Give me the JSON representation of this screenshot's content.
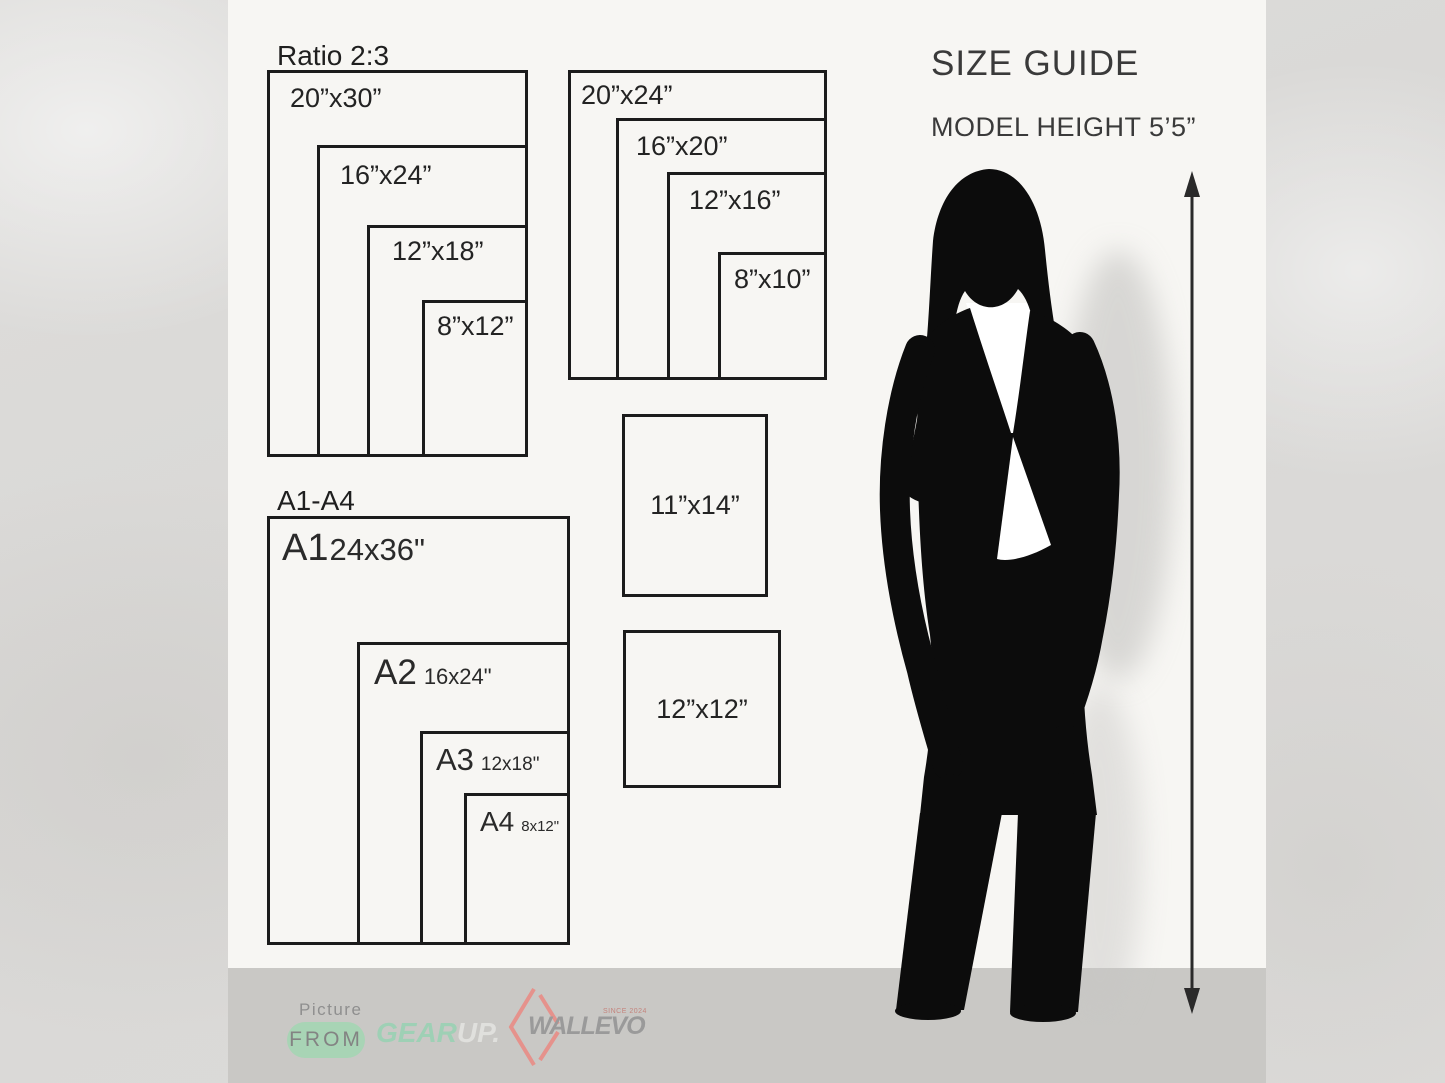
{
  "header": {
    "title": "SIZE GUIDE",
    "subtitle": "MODEL HEIGHT 5’5”"
  },
  "ratio_group": {
    "title": "Ratio 2:3",
    "sizes": [
      "20”x30”",
      "16”x24”",
      "12”x18”",
      "8”x12”"
    ]
  },
  "standard_group": {
    "sizes": [
      "20”x24”",
      "16”x20”",
      "12”x16”",
      "8”x10”"
    ]
  },
  "single_sizes": [
    "11”x14”",
    "12”x12”"
  ],
  "a_group": {
    "title": "A1-A4",
    "items": [
      {
        "name": "A1",
        "size": "24x36\""
      },
      {
        "name": "A2",
        "size": "16x24\""
      },
      {
        "name": "A3",
        "size": "12x18\""
      },
      {
        "name": "A4",
        "size": "8x12\""
      }
    ]
  },
  "footer": {
    "picture_label": "Picture",
    "from_label": "FROM",
    "gearup": {
      "part1": "GEAR",
      "part2": "UP."
    },
    "wallevo": {
      "name": "WALLEVO",
      "since": "SINCE 2024"
    }
  },
  "colors": {
    "card_bg": "#f7f6f3",
    "footer_band_bg": "#c9c8c5",
    "outer_bg": "#dcdbd9",
    "box_line": "#1b1b1b",
    "silhouette": "#0c0c0c",
    "mint_green": "#9ed0b5",
    "pill_green": "#a8d4b5",
    "logo_gray": "#9a9a9a",
    "diamond_pink": "#e5928c"
  }
}
